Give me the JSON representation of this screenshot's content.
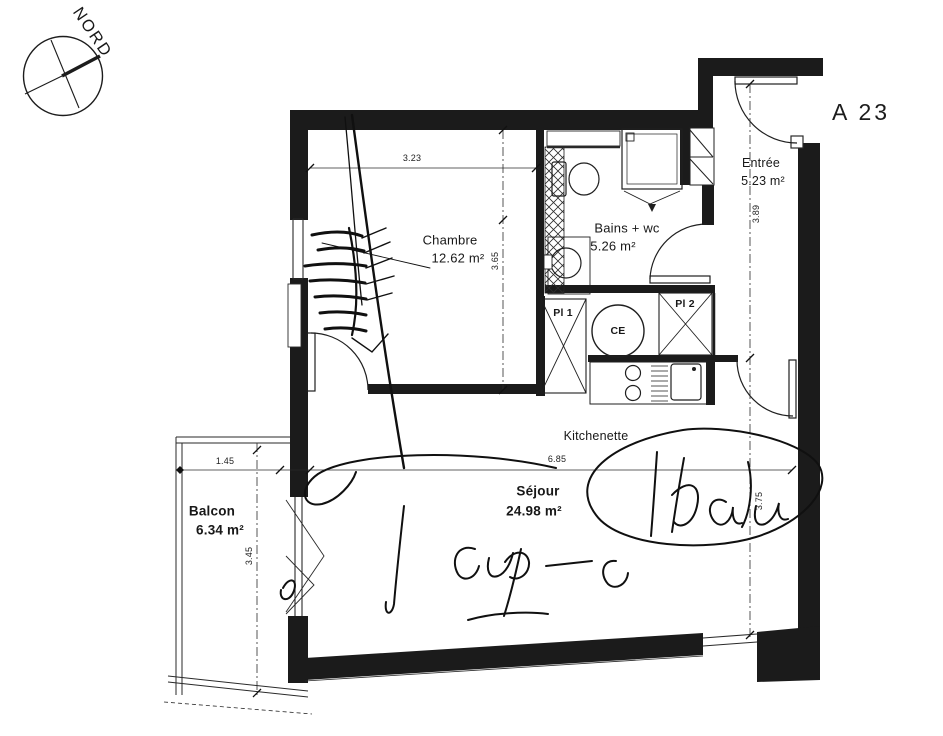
{
  "compass": {
    "label": "NORD"
  },
  "unit": {
    "label": "A 23"
  },
  "rooms": {
    "chambre": {
      "name": "Chambre",
      "area": "12.62 m²"
    },
    "bains": {
      "name": "Bains + wc",
      "area": "5.26 m²"
    },
    "entree": {
      "name": "Entrée",
      "area": "5.23 m²"
    },
    "sejour": {
      "name": "Séjour",
      "area": "24.98 m²"
    },
    "balcon": {
      "name": "Balcon",
      "area": "6.34 m²"
    },
    "kitchenette": {
      "name": "Kitchenette"
    }
  },
  "closets": {
    "pl1": "Pl 1",
    "pl2": "Pl 2"
  },
  "equipment": {
    "water_heater": "CE"
  },
  "dimensions": {
    "chambre_width": "3.23",
    "chambre_height": "3.65",
    "entree_height": "3.89",
    "sejour_width": "6.85",
    "sejour_height": "3.75",
    "balcon_width": "1.45",
    "balcon_height": "3.45"
  },
  "colors": {
    "wall": "#1b1b1b",
    "line": "#222222",
    "background": "#ffffff"
  }
}
